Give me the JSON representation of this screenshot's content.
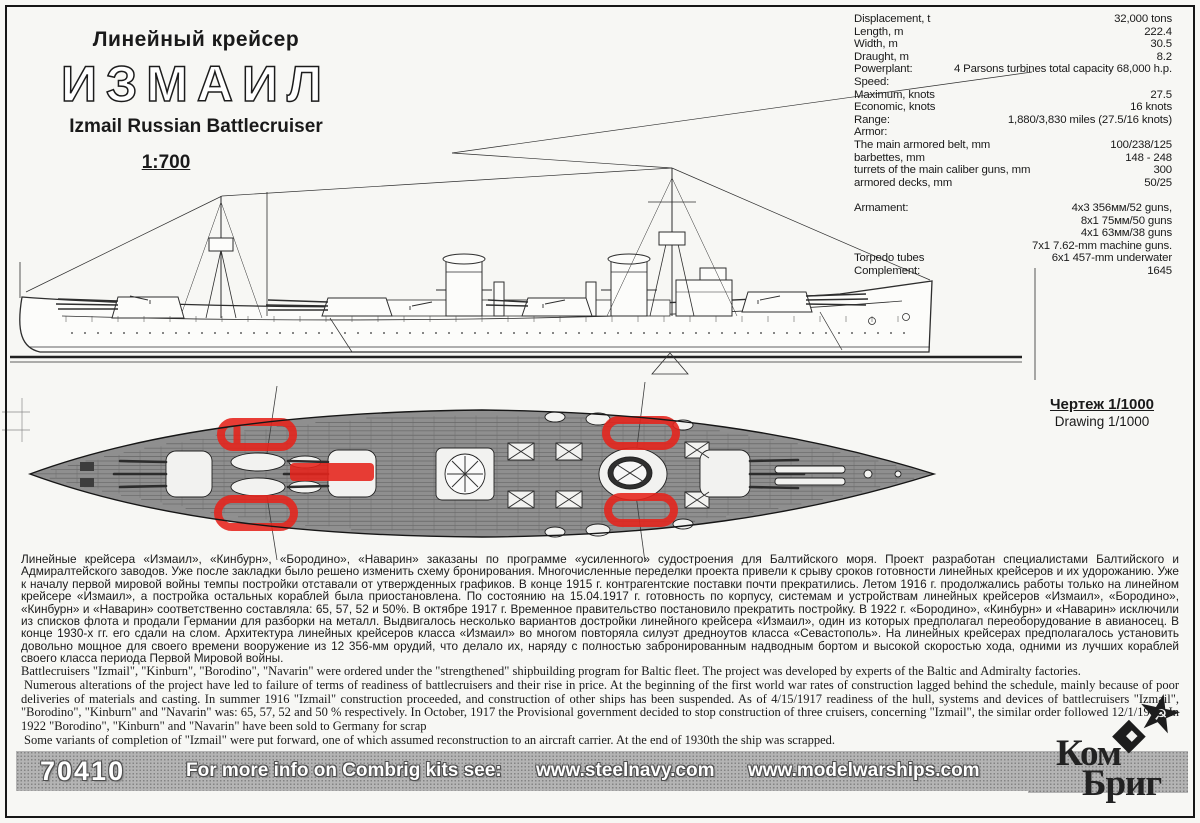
{
  "header": {
    "class_ru": "Линейный крейсер",
    "name_ru": "ИЗМАИЛ",
    "name_en": "Izmail Russian Battlecruiser",
    "scale": "1:700"
  },
  "specs": {
    "rows": [
      {
        "label": "Displacement, t",
        "value": "32,000 tons"
      },
      {
        "label": "Length, m",
        "value": "222.4"
      },
      {
        "label": "Width, m",
        "value": "30.5"
      },
      {
        "label": "Draught, m",
        "value": "8.2"
      },
      {
        "label": "Powerplant:",
        "value": "4  Parsons turbines total capacity 68,000 h.p."
      },
      {
        "label": "Speed:",
        "value": ""
      },
      {
        "label": "Maximum, knots",
        "value": "27.5"
      },
      {
        "label": "Economic, knots",
        "value": "16 knots"
      },
      {
        "label": "Range:",
        "value": "1,880/3,830 miles (27.5/16 knots)"
      },
      {
        "label": "Armor:",
        "value": ""
      },
      {
        "label": "The main armored belt, mm",
        "value": "100/238/125"
      },
      {
        "label": "barbettes, mm",
        "value": "148 - 248"
      },
      {
        "label": "turrets of the main caliber guns, mm",
        "value": "300"
      },
      {
        "label": "armored decks, mm",
        "value": "50/25"
      },
      {
        "label": "",
        "value": ""
      },
      {
        "label": "Armament:",
        "value": "4x3 356мм/52 guns,"
      },
      {
        "label": "",
        "value": "8x1 75мм/50 guns"
      },
      {
        "label": "",
        "value": "4x1 63мм/38 guns"
      },
      {
        "label": "",
        "value": "7x1 7.62-mm machine guns."
      },
      {
        "label": "Torpedo tubes",
        "value": "6x1 457-mm underwater"
      },
      {
        "label": "Complement:",
        "value": "1645"
      }
    ]
  },
  "drawing_label": {
    "ru": "Чертеж 1/1000",
    "en": "Drawing 1/1000"
  },
  "description_ru": "Линейные крейсера «Измаил», «Кинбурн», «Бородино», «Наварин» заказаны по программе «усиленного» судостроения для Балтийского моря. Проект разработан специалистами Балтийского и Адмиралтейского заводов. Уже после закладки было решено изменить схему бронирования. Многочисленные переделки проекта привели к срыву сроков готовности линейных крейсеров и их удорожанию. Уже к началу первой мировой войны темпы постройки отставали от утвержденных графиков. В конце 1915 г. контрагентские поставки почти прекратились. Летом 1916 г. продолжались работы только на линейном крейсере «Измаил», а постройка остальных кораблей была приостановлена. По состоянию на 15.04.1917 г. готовность по корпусу, системам и устройствам линейных крейсеров «Измаил», «Бородино», «Кинбурн» и «Наварин» соответственно составляла: 65, 57, 52 и 50%. В октябре 1917 г. Временное правительство постановило прекратить постройку. В 1922 г. «Бородино», «Кинбурн» и «Наварин» исключили из списков флота и продали Германии для разборки на металл. Выдвигалось несколько вариантов достройки линейного крейсера «Измаил», один из которых предполагал переоборудование в авианосец. В конце 1930-х гг. его сдали на слом. Архитектура линейных крейсеров класса «Измаил» во многом повторяла силуэт дредноутов класса «Севастополь».  На линейных крейсерах предполагалось установить довольно мощное для своего времени вооружение из 12 356-мм орудий, что делало их, наряду с полностью забронированным надводным бортом и высокой скоростью хода, одними из лучших кораблей своего класса периода Первой Мировой войны.",
  "description_en_paragraphs": [
    "Battlecruisers  \"Izmail\", \"Kinburn\", \"Borodino\",  \"Navarin\" were ordered under the  \"strengthened\" shipbuilding program for Baltic fleet. The project was developed by experts of the Baltic and Admiralty factories.",
    "Numerous alterations of the project have led to failure of terms of readiness of battlecruisers and their rise in price. At the  beginning of the first world war rates of construction lagged behind the schedule, mainly because of poor deliveries of materials and casting.  In summer 1916  \"Izmail\" construction  proceeded, and construction of other ships has been suspended. As of 4/15/1917 readiness of the hull, systems and devices of  battlecruisers \"Izmail\", \"Borodino\", \"Kinburn\" and \"Navarin\" was: 65, 57, 52 and 50 % respectively. In October, 1917 the Provisional government  decided to stop construction of three cruisers, concerning \"Izmail\", the similar order followed 12/1/1917. In 1922 \"Borodino\", \"Kinburn\" and \"Navarin\" have  been sold to Germany for scrap",
    "Some variants of completion of  \"Izmail\" were put forward, one of which assumed reconstruction to an aircraft carrier. At the end of 1930th the ship was scrapped."
  ],
  "footer": {
    "kit_number": "70410",
    "promo": "For more info on Combrig kits see:",
    "site1": "www.steelnavy.com",
    "site2": "www.modelwarships.com"
  },
  "logo": {
    "line1": "Ком",
    "line2": "Бриг",
    "star_icon": "hammer-and-sickle-star",
    "diamond_icon": "diamond-badge"
  },
  "colors": {
    "marker_red": "#e6231b",
    "deck_gray": "#8f8f8f",
    "band_gray": "#b4b4b4",
    "ink": "#1a1a1a"
  }
}
